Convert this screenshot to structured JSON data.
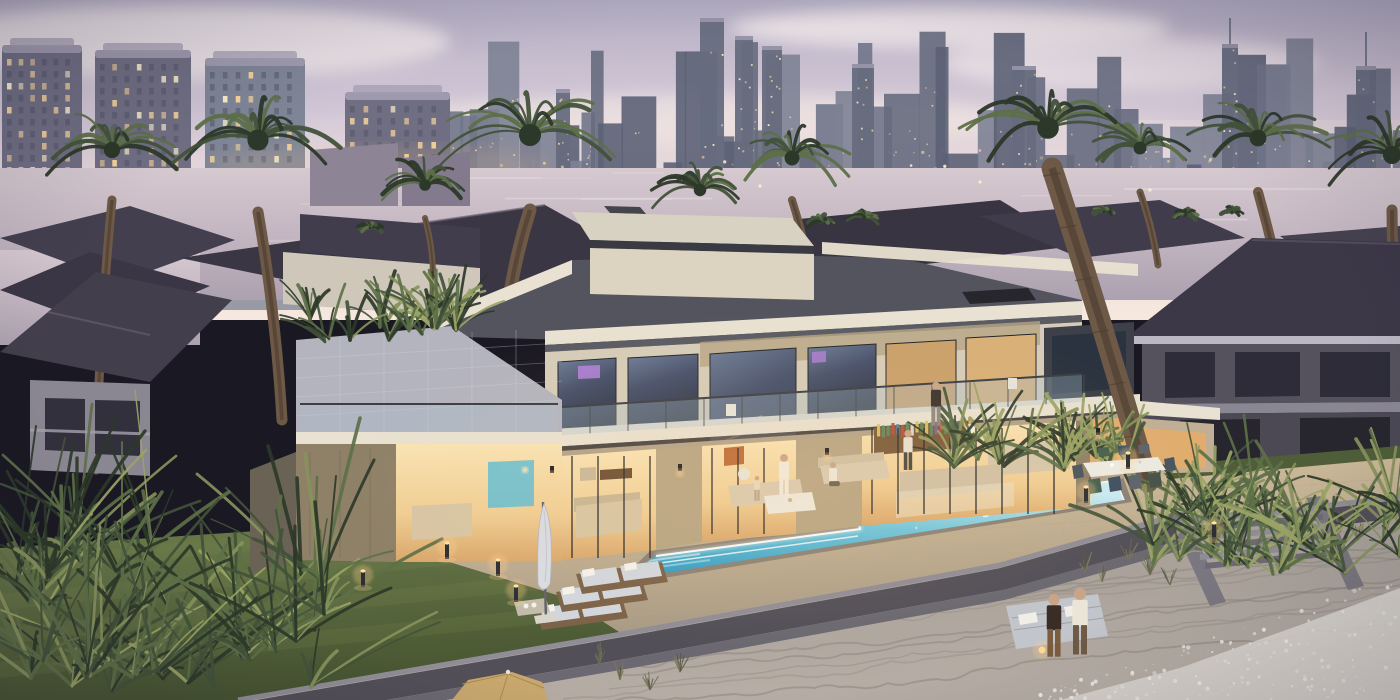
{
  "scene": {
    "title": "Luxury beachfront villa at dusk with pool, palms and city skyline",
    "time_of_day": "dusk",
    "style": "3D architectural rendering, waterfront community with high-rise skyline",
    "visible_text": "none"
  },
  "palette": {
    "sky_top": "#b3adc3",
    "sky_mid": "#d9cdd9",
    "sky_low": "#eedfdd",
    "horizon_glow": "#f6e8de",
    "cloud_light": "#f2e9ea",
    "cloud_shadow": "#c2b9cf",
    "tower_body": "#6f6e82",
    "tower_crown": "#a39db0",
    "tower_glass": "#7e8596",
    "window_warm": "#f8d49c",
    "window_bright": "#fff1cd",
    "window_off": "#55546a",
    "far_tower_1": "#5c6275",
    "far_tower_2": "#666c7e",
    "far_tower_3": "#717689",
    "far_tower_4": "#7d8294",
    "city_glow": "#ffc98e",
    "lagoon_hi": "#cfc2cb",
    "lagoon_lo": "#b0a5b3",
    "lagoon_streak": "#e9e0e0",
    "roof_dark": "#3c3848",
    "roof_ridge": "#6b6375",
    "villa_cream": "#d6ccb9",
    "fascia": "#e9e1d1",
    "roof_graphite": "#53545e",
    "box_top": "#d8d2c3",
    "box_edge": "#3a3a42",
    "stone": "#b7a584",
    "stone_dim": "#8f8168",
    "glass_dark": "#343b49",
    "glass_sky": "#8fa3b5",
    "interior_hi": "#f6d9a6",
    "interior_lo": "#e0ad6f",
    "tv_purple": "#b07fd6",
    "tile": "#b4b4be",
    "deck_warm": "#cdbb98",
    "deck_cool": "#a89a85",
    "lawn_hi": "#677748",
    "lawn_lo": "#49582f",
    "wall_cap": "#908d96",
    "wall_face": "#524f58",
    "wall_step": "#6b6871",
    "stair_hi": "#8f8c95",
    "stair_lo": "#6d6a74",
    "sand_hi": "#b2aaa2",
    "sand_lo": "#9a938c",
    "ripple": "#8b847e",
    "foam": "#dcd7d0",
    "pool_far": "#c8ebf2",
    "pool_mid": "#58bcd8",
    "pool_near": "#2f9cc4",
    "pool_led": "#ffffff",
    "coping": "#8a8176",
    "palm_dark": "#2c3829",
    "palm_mid": "#42523a",
    "palm_light": "#5d7048",
    "palm_lit": "#87935c",
    "trunk": "#6d5946",
    "trunk_dark": "#4b3c2e",
    "wood": "#7c6248",
    "cushion": "#d2d6dd",
    "cloth_white": "#efe9dd",
    "umbrella_tan": "#c8a86d",
    "glow": "#ffcf8e",
    "skin": "#c9a588"
  },
  "skyline": {
    "near_towers": [
      {
        "x": 2,
        "w": 80,
        "top": 45,
        "base": 310,
        "cols": 6
      },
      {
        "x": 95,
        "w": 96,
        "top": 50,
        "base": 310,
        "cols": 7
      },
      {
        "x": 205,
        "w": 100,
        "top": 58,
        "base": 310,
        "cols": 7,
        "glassy": true
      },
      {
        "x": 345,
        "w": 105,
        "top": 92,
        "base": 310,
        "cols": 7
      }
    ],
    "far_towers": {
      "seed": 11,
      "count": 50,
      "x0": 440,
      "x1": 1398,
      "base": 214,
      "hmin": 45,
      "hmax": 185
    },
    "spires": [
      {
        "x": 556,
        "h": 125,
        "w": 14
      },
      {
        "x": 700,
        "h": 196,
        "w": 24
      },
      {
        "x": 735,
        "h": 178,
        "w": 18
      },
      {
        "x": 762,
        "h": 168,
        "w": 20
      },
      {
        "x": 852,
        "h": 150,
        "w": 22
      },
      {
        "x": 1012,
        "h": 148,
        "w": 24
      },
      {
        "x": 1222,
        "h": 170,
        "w": 16,
        "needle": 26
      },
      {
        "x": 1356,
        "h": 148,
        "w": 20,
        "needle": 34
      }
    ]
  },
  "palms": {
    "background": [
      {
        "cx": 112,
        "cy": 150,
        "r": 68
      },
      {
        "cx": 258,
        "cy": 140,
        "r": 88
      },
      {
        "cx": 425,
        "cy": 185,
        "r": 48
      },
      {
        "cx": 530,
        "cy": 135,
        "r": 92
      },
      {
        "cx": 700,
        "cy": 190,
        "r": 52
      },
      {
        "cx": 792,
        "cy": 158,
        "r": 62
      },
      {
        "cx": 1140,
        "cy": 148,
        "r": 54
      },
      {
        "cx": 1258,
        "cy": 138,
        "r": 70
      },
      {
        "cx": 1392,
        "cy": 155,
        "r": 75
      }
    ],
    "bg_trunks": [
      [
        112,
        200,
        96,
        470,
        9
      ],
      [
        258,
        212,
        282,
        420,
        11
      ],
      [
        530,
        210,
        505,
        330,
        13
      ],
      [
        792,
        200,
        818,
        320,
        8
      ],
      [
        1140,
        192,
        1158,
        265,
        7
      ],
      [
        1258,
        192,
        1288,
        320,
        10
      ],
      [
        1392,
        210,
        1400,
        330,
        11
      ],
      [
        425,
        218,
        432,
        300,
        6
      ],
      [
        228,
        575,
        230,
        700,
        8
      ]
    ],
    "foreground": [
      {
        "cx": 1048,
        "cy": 128,
        "r": 90,
        "trunk": [
          1052,
          168,
          1148,
          482,
          21
        ]
      }
    ],
    "distant": [
      [
        820,
        222,
        14
      ],
      [
        864,
        218,
        16
      ],
      [
        1104,
        212,
        12
      ],
      [
        1185,
        215,
        13
      ],
      [
        1232,
        212,
        11
      ],
      [
        370,
        228,
        12
      ]
    ]
  },
  "vegetation": {
    "left_cluster": {
      "x0": 0,
      "x1": 360,
      "y0": 470,
      "y1": 700,
      "n": 48
    },
    "right_garden": {
      "x0": 1150,
      "x1": 1400,
      "y0": 468,
      "y1": 575,
      "n": 38
    },
    "center_shrubs": {
      "x0": 945,
      "x1": 1140,
      "y0": 428,
      "y1": 474,
      "n": 22
    },
    "terrace_planting": {
      "x0": 300,
      "x1": 458,
      "y0": 300,
      "y1": 342,
      "n": 16
    },
    "grass_tufts": [
      [
        1128,
        560
      ],
      [
        1150,
        575
      ],
      [
        1170,
        585
      ],
      [
        1240,
        552
      ],
      [
        1262,
        560
      ],
      [
        1300,
        540
      ],
      [
        1340,
        532
      ],
      [
        1358,
        540
      ],
      [
        1085,
        572
      ],
      [
        1102,
        582
      ],
      [
        620,
        680
      ],
      [
        650,
        690
      ],
      [
        680,
        672
      ],
      [
        600,
        664
      ]
    ]
  },
  "people": [
    {
      "id": "balcony-woman",
      "x": 936,
      "y": 382,
      "h": 46,
      "top": "#3a332e",
      "bottom": "#8e887f",
      "desc": "woman standing on upper balcony"
    },
    {
      "id": "interior-man",
      "x": 908,
      "y": 430,
      "h": 42,
      "top": "#e6e0d0",
      "bottom": "#4a4540",
      "desc": "man walking in lounge"
    },
    {
      "id": "terrace-woman",
      "x": 784,
      "y": 454,
      "h": 46,
      "top": "#f1ebe0",
      "bottom": "#f1ebe0",
      "desc": "woman in white robe on terrace"
    },
    {
      "id": "terrace-man-seated",
      "x": 833,
      "y": 462,
      "h": 36,
      "seated": true,
      "top": "#eee8dc",
      "bottom": "#6b5f4e",
      "desc": "seated man on terrace sofa"
    },
    {
      "id": "terrace-child",
      "x": 757,
      "y": 476,
      "h": 26,
      "top": "#e8d8c0",
      "bottom": "#b8a48c",
      "desc": "child on terrace"
    },
    {
      "id": "beach-man-dark",
      "x": 1054,
      "y": 594,
      "h": 66,
      "top": "#3a2d26",
      "bottom": "#7c5c3e",
      "desc": "man in dark shirt on beach"
    },
    {
      "id": "beach-man-white",
      "x": 1080,
      "y": 588,
      "h": 70,
      "top": "#ebe5d8",
      "bottom": "#6e5a45",
      "desc": "man in white shirt on beach"
    }
  ],
  "lights": {
    "bollards": [
      [
        363,
        577
      ],
      [
        447,
        549
      ],
      [
        498,
        566
      ],
      [
        516,
        592
      ],
      [
        1086,
        493
      ],
      [
        1128,
        459
      ],
      [
        1214,
        529
      ]
    ],
    "sconces": [
      [
        552,
        470
      ],
      [
        680,
        468
      ],
      [
        827,
        452
      ],
      [
        1098,
        432
      ]
    ]
  },
  "furniture": {
    "sun_loungers": 3,
    "outdoor_dining_seats": 9,
    "terrace_sofas": 2,
    "closed_umbrella": 1,
    "beach_umbrella": 1,
    "beach_double_lounger": 1,
    "book_colors": [
      "#b84f3e",
      "#5d7a9e",
      "#d8c35e",
      "#5f8a5f",
      "#8a5fa0",
      "#e0e0d8",
      "#c9884a"
    ]
  },
  "pool": {
    "shape": "L-shaped infinity pool",
    "led_edge": true
  }
}
